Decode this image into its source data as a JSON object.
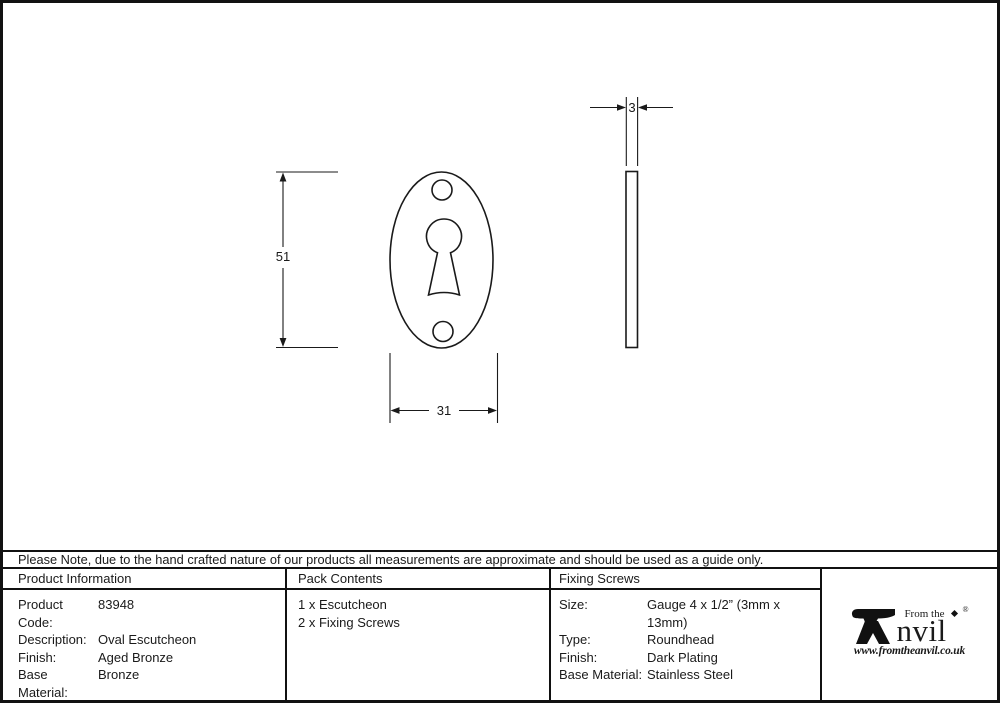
{
  "note": "Please Note, due to the hand crafted nature of our products all measurements are approximate and should be used as a guide only.",
  "drawing": {
    "dim_height": "51",
    "dim_width": "31",
    "dim_thickness": "3"
  },
  "table": {
    "product_information": {
      "header": "Product Information",
      "rows": [
        {
          "label": "Product Code:",
          "value": "83948"
        },
        {
          "label": "Description:",
          "value": "Oval Escutcheon"
        },
        {
          "label": "Finish:",
          "value": "Aged Bronze"
        },
        {
          "label": "Base Material:",
          "value": "Bronze"
        }
      ]
    },
    "pack_contents": {
      "header": "Pack Contents",
      "items": [
        "1 x Escutcheon",
        "2 x Fixing Screws"
      ]
    },
    "fixing_screws": {
      "header": "Fixing Screws",
      "rows": [
        {
          "label": "Size:",
          "value": "Gauge 4 x 1/2” (3mm x 13mm)"
        },
        {
          "label": "Type:",
          "value": "Roundhead"
        },
        {
          "label": "Finish:",
          "value": "Dark Plating"
        },
        {
          "label": "Base Material:",
          "value": "Stainless Steel"
        }
      ]
    }
  },
  "logo": {
    "tagline": "From the",
    "brand_rest": "nvil",
    "registered": "®",
    "website": "www.fromtheanvil.co.uk"
  },
  "colors": {
    "line": "#1a1a1a",
    "background": "#ffffff"
  }
}
